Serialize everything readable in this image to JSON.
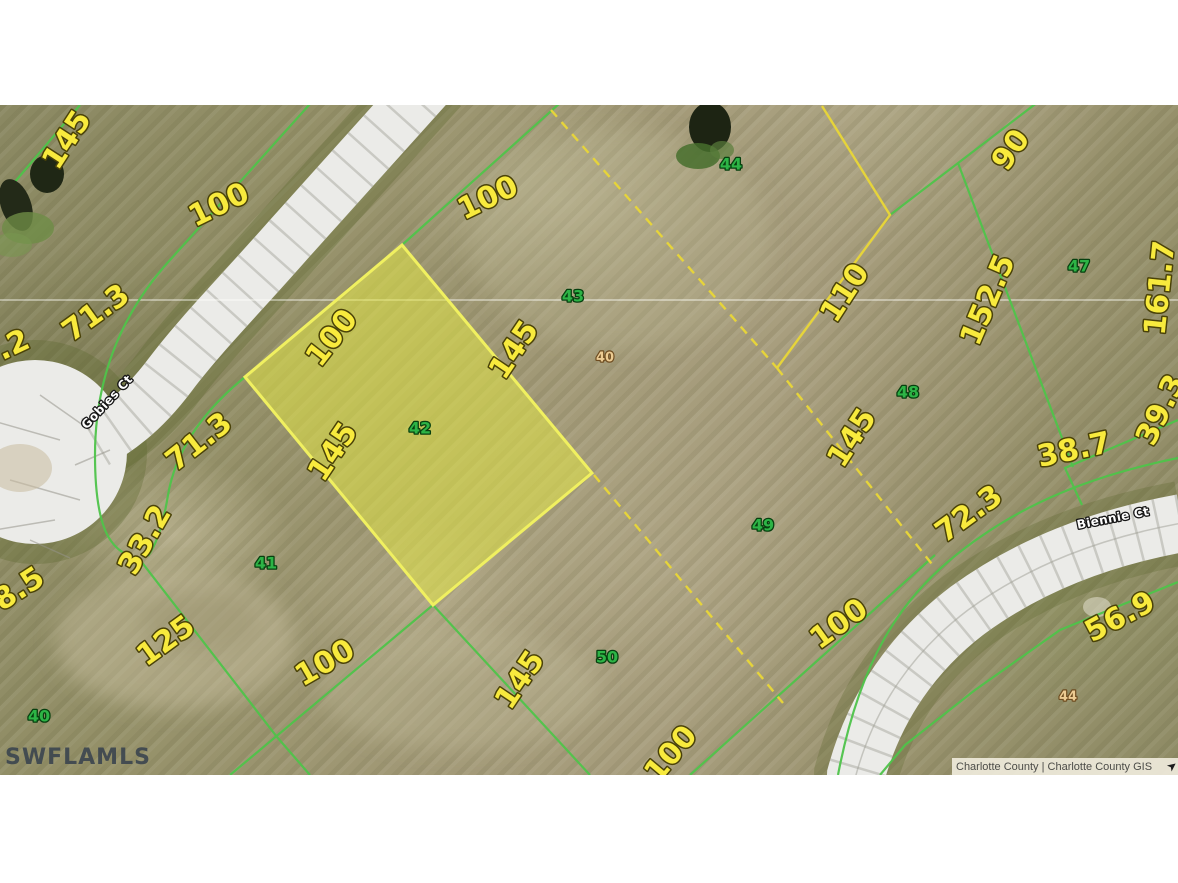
{
  "page": {
    "watermark": "SWFLAMLS",
    "attribution": "Charlotte County | Charlotte County GIS"
  },
  "colors": {
    "dimension_text": "#f8ea3d",
    "lot_number_green": "#2db446",
    "lot_number_tan": "#eccb92",
    "parcel_highlight_fill": "#e9ec5e",
    "boundary_green": "#4fc44a",
    "boundary_yellow": "#e6d43a",
    "road": "#ebebe8",
    "watermark_text": "#39434e"
  },
  "map": {
    "highlighted_lot": {
      "number": "42"
    },
    "streets": [
      {
        "name": "Gobies Ct",
        "x": 107,
        "y": 402,
        "rot": -47
      },
      {
        "name": "Biennie Ct",
        "x": 1113,
        "y": 518,
        "rot": -11
      }
    ],
    "dimension_labels": [
      {
        "text": "145",
        "x": 67,
        "y": 140,
        "rot": -57
      },
      {
        "text": "100",
        "x": 219,
        "y": 205,
        "rot": -26
      },
      {
        "text": ".2",
        "x": 13,
        "y": 345,
        "rot": -25
      },
      {
        "text": "71.3",
        "x": 96,
        "y": 313,
        "rot": -36
      },
      {
        "text": "100",
        "x": 488,
        "y": 198,
        "rot": -26
      },
      {
        "text": "100",
        "x": 332,
        "y": 338,
        "rot": -52
      },
      {
        "text": "145",
        "x": 514,
        "y": 350,
        "rot": -56
      },
      {
        "text": "145",
        "x": 333,
        "y": 452,
        "rot": -56
      },
      {
        "text": "71.3",
        "x": 199,
        "y": 442,
        "rot": -38
      },
      {
        "text": "33.2",
        "x": 145,
        "y": 540,
        "rot": -60
      },
      {
        "text": "8.5",
        "x": 19,
        "y": 589,
        "rot": -33
      },
      {
        "text": "125",
        "x": 166,
        "y": 641,
        "rot": -36
      },
      {
        "text": "100",
        "x": 325,
        "y": 663,
        "rot": -30
      },
      {
        "text": "145",
        "x": 520,
        "y": 680,
        "rot": -56
      },
      {
        "text": "100",
        "x": 671,
        "y": 754,
        "rot": -50
      },
      {
        "text": "90",
        "x": 1011,
        "y": 150,
        "rot": -55
      },
      {
        "text": "110",
        "x": 845,
        "y": 293,
        "rot": -57
      },
      {
        "text": "152.5",
        "x": 988,
        "y": 300,
        "rot": -67
      },
      {
        "text": "161.7",
        "x": 1160,
        "y": 288,
        "rot": -84
      },
      {
        "text": "39.3",
        "x": 1161,
        "y": 410,
        "rot": -64
      },
      {
        "text": "38.7",
        "x": 1074,
        "y": 450,
        "rot": -12
      },
      {
        "text": "145",
        "x": 852,
        "y": 438,
        "rot": -57
      },
      {
        "text": "72.3",
        "x": 969,
        "y": 514,
        "rot": -36
      },
      {
        "text": "100",
        "x": 839,
        "y": 624,
        "rot": -36
      },
      {
        "text": "56.9",
        "x": 1120,
        "y": 617,
        "rot": -28
      }
    ],
    "lot_numbers_green": [
      {
        "text": "42",
        "x": 420,
        "y": 428
      },
      {
        "text": "43",
        "x": 573,
        "y": 296
      },
      {
        "text": "44",
        "x": 731,
        "y": 164
      },
      {
        "text": "47",
        "x": 1079,
        "y": 266
      },
      {
        "text": "48",
        "x": 908,
        "y": 392
      },
      {
        "text": "49",
        "x": 763,
        "y": 525
      },
      {
        "text": "50",
        "x": 607,
        "y": 657
      },
      {
        "text": "41",
        "x": 266,
        "y": 563
      },
      {
        "text": "40",
        "x": 39,
        "y": 716
      }
    ],
    "lot_numbers_tan": [
      {
        "text": "40",
        "x": 605,
        "y": 358
      },
      {
        "text": "44",
        "x": 1068,
        "y": 697
      }
    ]
  }
}
